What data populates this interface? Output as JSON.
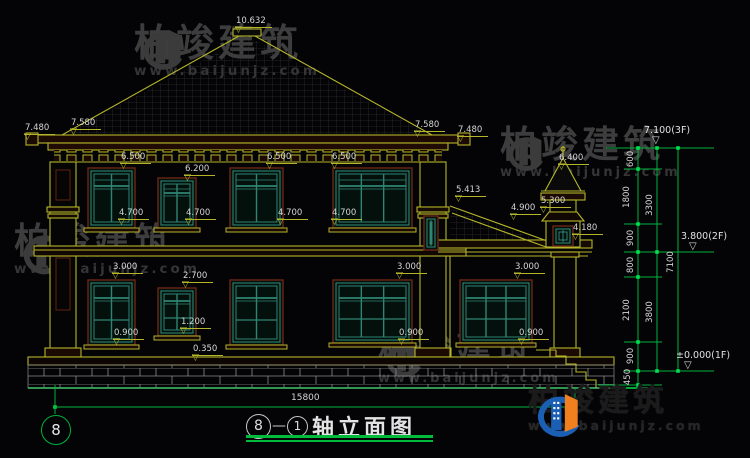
{
  "colors": {
    "cad_yellow": "#b5b52a",
    "cad_green": "#00b33c",
    "dim_text": "#d6d6d6",
    "window_teal": "#2e8573",
    "frame_maroon": "#6b2615",
    "watermark_gray": "#3d3d3d",
    "logo_blue": "#1a5fb4",
    "logo_orange": "#f07f1f"
  },
  "watermark": {
    "brand": "柏竣建筑",
    "url": "www.baijunjz.com"
  },
  "title": {
    "axis_start": "8",
    "separator": "—",
    "axis_end": "1",
    "name": "轴立面图"
  },
  "grid_bubble": "8",
  "dims": {
    "total_width": "15800",
    "elevation_marks": [
      {
        "t": "10.632",
        "x": 235,
        "y": 16
      },
      {
        "t": "7.480",
        "x": 24,
        "y": 123
      },
      {
        "t": "7.580",
        "x": 70,
        "y": 118
      },
      {
        "t": "7.580",
        "x": 414,
        "y": 120
      },
      {
        "t": "7.480",
        "x": 457,
        "y": 125
      },
      {
        "t": "6.500",
        "x": 120,
        "y": 152
      },
      {
        "t": "6.200",
        "x": 184,
        "y": 164
      },
      {
        "t": "6.500",
        "x": 266,
        "y": 152
      },
      {
        "t": "6.500",
        "x": 331,
        "y": 152
      },
      {
        "t": "4.700",
        "x": 118,
        "y": 208
      },
      {
        "t": "4.700",
        "x": 185,
        "y": 208
      },
      {
        "t": "4.700",
        "x": 277,
        "y": 208
      },
      {
        "t": "4.700",
        "x": 331,
        "y": 208
      },
      {
        "t": "5.413",
        "x": 455,
        "y": 185
      },
      {
        "t": "6.400",
        "x": 558,
        "y": 153
      },
      {
        "t": "5.300",
        "x": 540,
        "y": 196
      },
      {
        "t": "4.900",
        "x": 510,
        "y": 203
      },
      {
        "t": "4.180",
        "x": 572,
        "y": 223
      },
      {
        "t": "3.000",
        "x": 112,
        "y": 262
      },
      {
        "t": "2.700",
        "x": 182,
        "y": 271
      },
      {
        "t": "3.000",
        "x": 396,
        "y": 262
      },
      {
        "t": "3.000",
        "x": 514,
        "y": 262
      },
      {
        "t": "0.900",
        "x": 113,
        "y": 328
      },
      {
        "t": "1.200",
        "x": 180,
        "y": 317
      },
      {
        "t": "0.900",
        "x": 398,
        "y": 328
      },
      {
        "t": "0.900",
        "x": 518,
        "y": 328
      },
      {
        "t": "0.350",
        "x": 192,
        "y": 344
      }
    ],
    "level_marks": [
      {
        "t": "7.100(3F)",
        "x": 644,
        "y": 125
      },
      {
        "t": "3.800(2F)",
        "x": 681,
        "y": 231
      },
      {
        "t": "±0.000(1F)",
        "x": 676,
        "y": 350
      }
    ],
    "chain_marks": [
      {
        "t": "600",
        "x": 631,
        "y": 159
      },
      {
        "t": "1800",
        "x": 627,
        "y": 197
      },
      {
        "t": "900",
        "x": 631,
        "y": 238
      },
      {
        "t": "800",
        "x": 631,
        "y": 265
      },
      {
        "t": "2100",
        "x": 627,
        "y": 310
      },
      {
        "t": "900",
        "x": 631,
        "y": 356
      },
      {
        "t": "450",
        "x": 628,
        "y": 377
      },
      {
        "t": "3300",
        "x": 650,
        "y": 205
      },
      {
        "t": "3800",
        "x": 650,
        "y": 312
      },
      {
        "t": "7100",
        "x": 671,
        "y": 262
      }
    ]
  }
}
